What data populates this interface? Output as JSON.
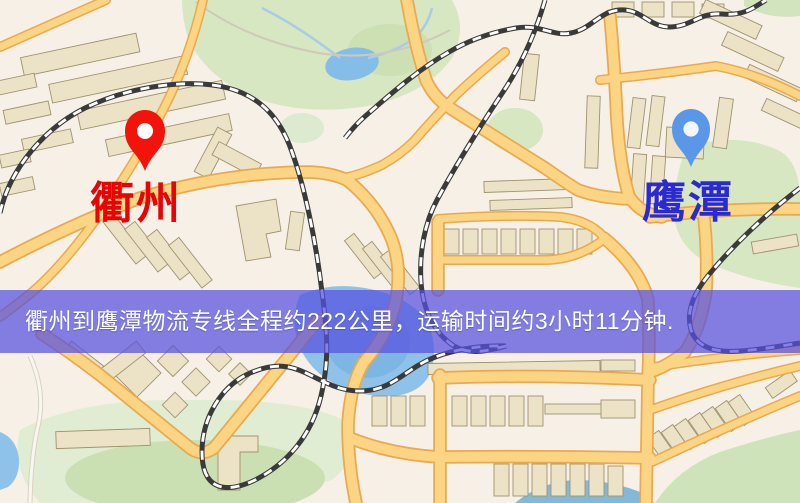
{
  "window": {
    "width_px": 800,
    "height_px": 503,
    "kind": "logistics-route-map-image"
  },
  "map": {
    "origin": {
      "label": "衢州",
      "marker": "red-map-pin",
      "marker_color": "#f2140b",
      "label_color": "#e80404"
    },
    "destination": {
      "label": "鹰潭",
      "marker": "blue-map-pin",
      "marker_color": "#5b97e9",
      "label_color": "#2a2ad2"
    },
    "banner": {
      "text": "衢州到鹰潭物流专线全程约222公里，运输时间约3小时11分钟.",
      "background_color": "#5650df",
      "text_color": "#ffffff"
    },
    "route": {
      "origin": "衢州",
      "destination": "鹰潭",
      "service": "物流专线",
      "distance_km": 222,
      "distance_text": "全程约222公里",
      "duration_text": "运输时间约3小时11分钟",
      "duration_hours": 3,
      "duration_minutes": 11
    }
  }
}
